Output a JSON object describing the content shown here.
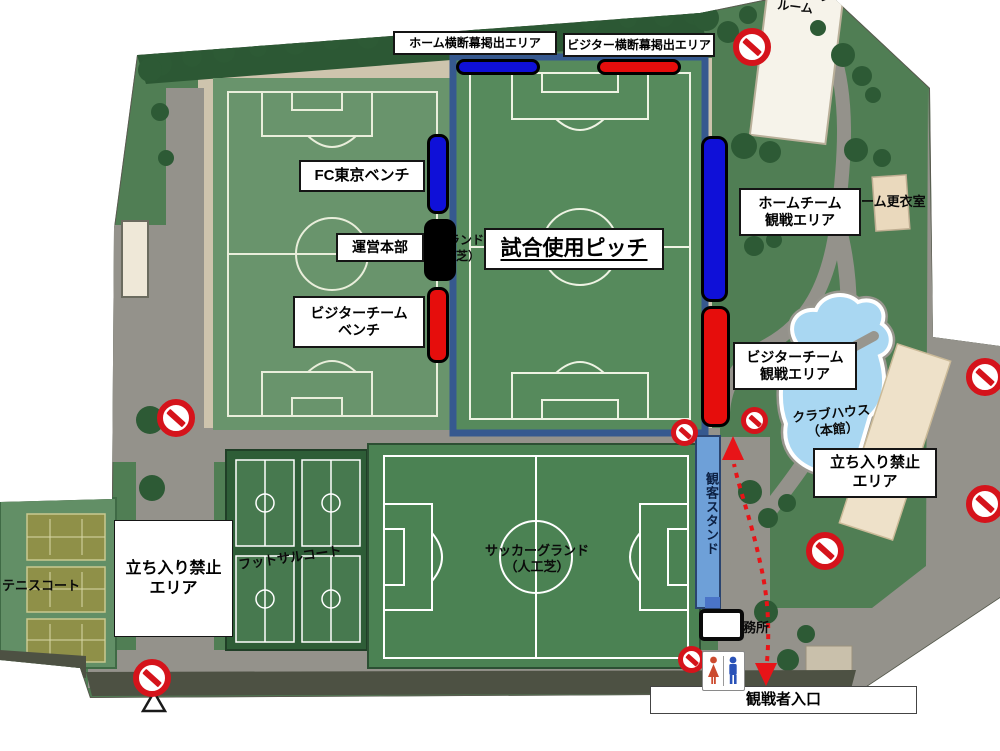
{
  "pitch_labels": {
    "home_banner": "ホーム横断幕掲出エリア",
    "visitor_banner": "ビジター横断幕掲出エリア",
    "fc_tokyo_bench": "FC東京ベンチ",
    "operations_hq": "運営本部",
    "visitor_bench": [
      "ビジターチーム",
      "ベンチ"
    ],
    "match_pitch": "試合使用ピッチ",
    "home_stand": [
      "ホームチーム",
      "観戦エリア"
    ],
    "visitor_stand": [
      "ビジターチーム",
      "観戦エリア"
    ],
    "no_entry_right": [
      "立ち入り禁止",
      "エリア"
    ],
    "no_entry_left": [
      "立ち入り禁止",
      "エリア"
    ],
    "spectator_entrance": "観戦者入口"
  },
  "facilities": {
    "meeting_room": [
      "ミーティング",
      "ルーム"
    ],
    "home_locker_room": "ホーム更衣室",
    "clubhouse": [
      "クラブハウス",
      "（本館）"
    ],
    "tennis_court": "テニスコート",
    "futsal_court": "フットサルコート",
    "soccer_ground": [
      "サッカーグランド",
      "（人工芝）"
    ],
    "spectator_stand": "観客スタンド",
    "office": "事務所",
    "obscured_pitch_label": [
      "ランド",
      "（",
      "芝）"
    ]
  },
  "markers": {
    "home_color": "#0f10d8",
    "visitor_color": "#e60d0c",
    "operations_color": "#000000",
    "no_entry_sign_color": "#d5131b",
    "route_color": "#e81418",
    "stand_color": "#6e9fd7",
    "pond_color": "#a9d7f2",
    "grass_color": "#507e54"
  }
}
